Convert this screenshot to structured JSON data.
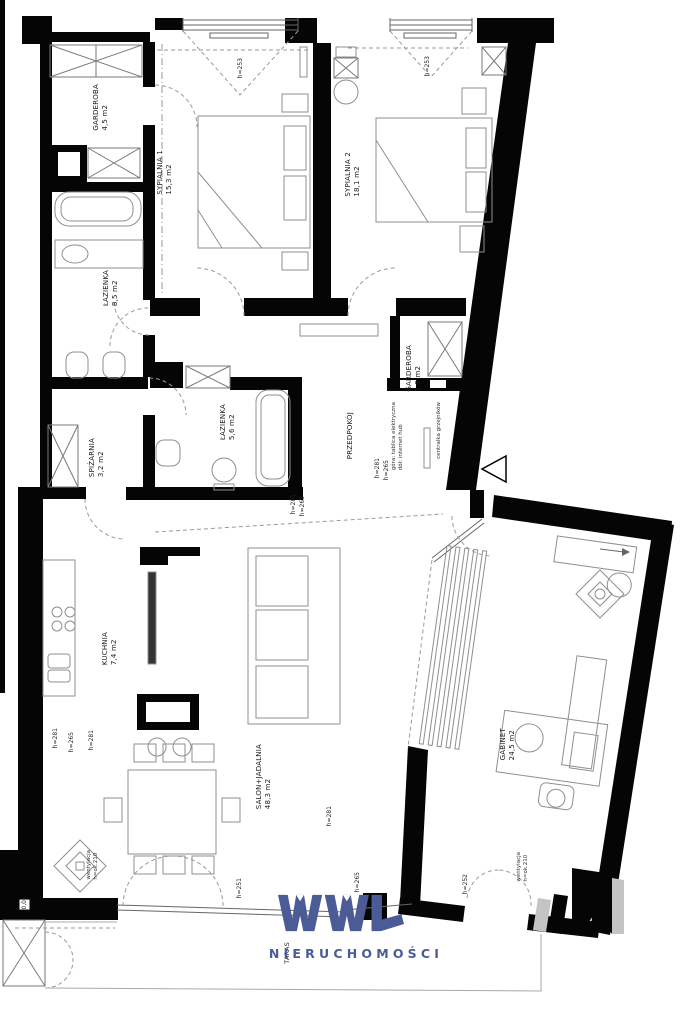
{
  "rooms": {
    "garderoba1": {
      "name": "GARDEROBA",
      "area": "4,5 m2"
    },
    "sypialnia1": {
      "name": "SYPIALNIA 1",
      "area": "15,3 m2"
    },
    "sypialnia2": {
      "name": "SYPIALNIA 2",
      "area": "18,1 m2"
    },
    "lazienka1": {
      "name": "ŁAZIENKA",
      "area": "8,5 m2"
    },
    "spizarnia": {
      "name": "SPIŻARNIA",
      "area": "3,2 m2"
    },
    "lazienka2": {
      "name": "ŁAZIENKA",
      "area": "5,6 m2"
    },
    "garderoba2": {
      "name": "GARDEROBA",
      "area": "1,9 m2"
    },
    "przedpokoj": {
      "name": "PRZEDPOKÓJ",
      "area": ""
    },
    "kuchnia": {
      "name": "KUCHNIA",
      "area": "7,4 m2"
    },
    "salon": {
      "name": "SALON+JADALNIA",
      "area": "48,3 m2"
    },
    "gabinet": {
      "name": "GABINET",
      "area": "24,5 m2"
    },
    "taras": {
      "name": "TARAS",
      "area": ""
    }
  },
  "dims": {
    "h253": "h=253",
    "h281": "h=281",
    "h265": "h=265",
    "h251": "h=251",
    "h252": "h=252",
    "level": "0,0"
  },
  "vent": {
    "line1": "wentylacja",
    "line2": "h=ok.210"
  },
  "notes": {
    "electrical1": "góra: tablica elektryczna",
    "electrical2": "dół: internet hub",
    "heating": "centralka grzejników"
  },
  "logo": {
    "brand": "WWL",
    "subtitle": "NIERUCHOMOŚCI",
    "color": "#4a5b96"
  },
  "colors": {
    "wall": "#050505",
    "line": "#8f8f8f",
    "bg": "#ffffff"
  }
}
